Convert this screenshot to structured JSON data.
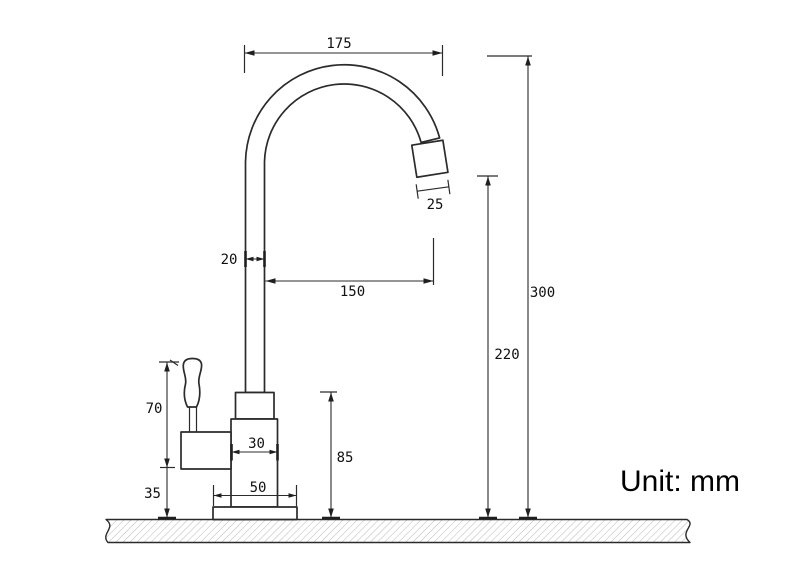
{
  "diagram": {
    "unit_label": "Unit: mm",
    "dimensions": {
      "spout_arc_width": "175",
      "aerator_size": "25",
      "pipe_diameter": "20",
      "spout_reach": "150",
      "total_height": "300",
      "outlet_height": "220",
      "handle_height": "70",
      "valve_base_gap": "35",
      "body_width": "30",
      "base_width": "50",
      "body_height": "85"
    }
  }
}
